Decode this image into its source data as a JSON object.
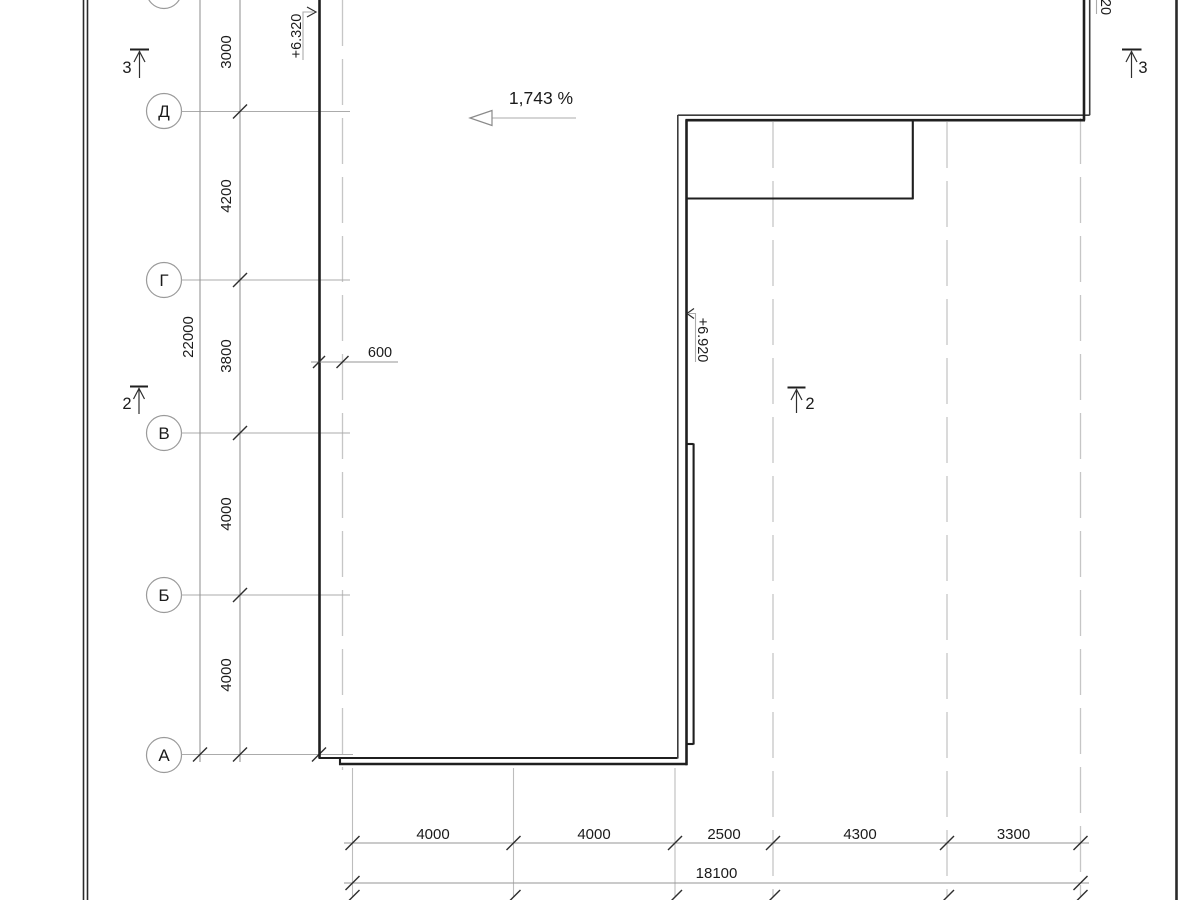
{
  "axes": {
    "row_labels": [
      "Д",
      "Г",
      "В",
      "Б",
      "А"
    ]
  },
  "dims_vertical": {
    "segments": [
      "3000",
      "4200",
      "3800",
      "4000",
      "4000"
    ],
    "total": "22000"
  },
  "dims_horizontal": {
    "segments": [
      "4000",
      "4000",
      "2500",
      "4300",
      "3300"
    ],
    "total": "18100"
  },
  "offset_dim": "600",
  "slope_label": "1,743 %",
  "elevations": {
    "left": "+6.320",
    "middle": "+6.920",
    "top_right_partial": "20"
  },
  "section_markers": {
    "section_3": "3",
    "section_2": "2"
  },
  "colors": {
    "background": "#ffffff",
    "outline_dark": "#1f1f1f",
    "dimension_grey": "#969696",
    "grid_light": "#c6c6c6",
    "text": "#1b1b1b"
  }
}
